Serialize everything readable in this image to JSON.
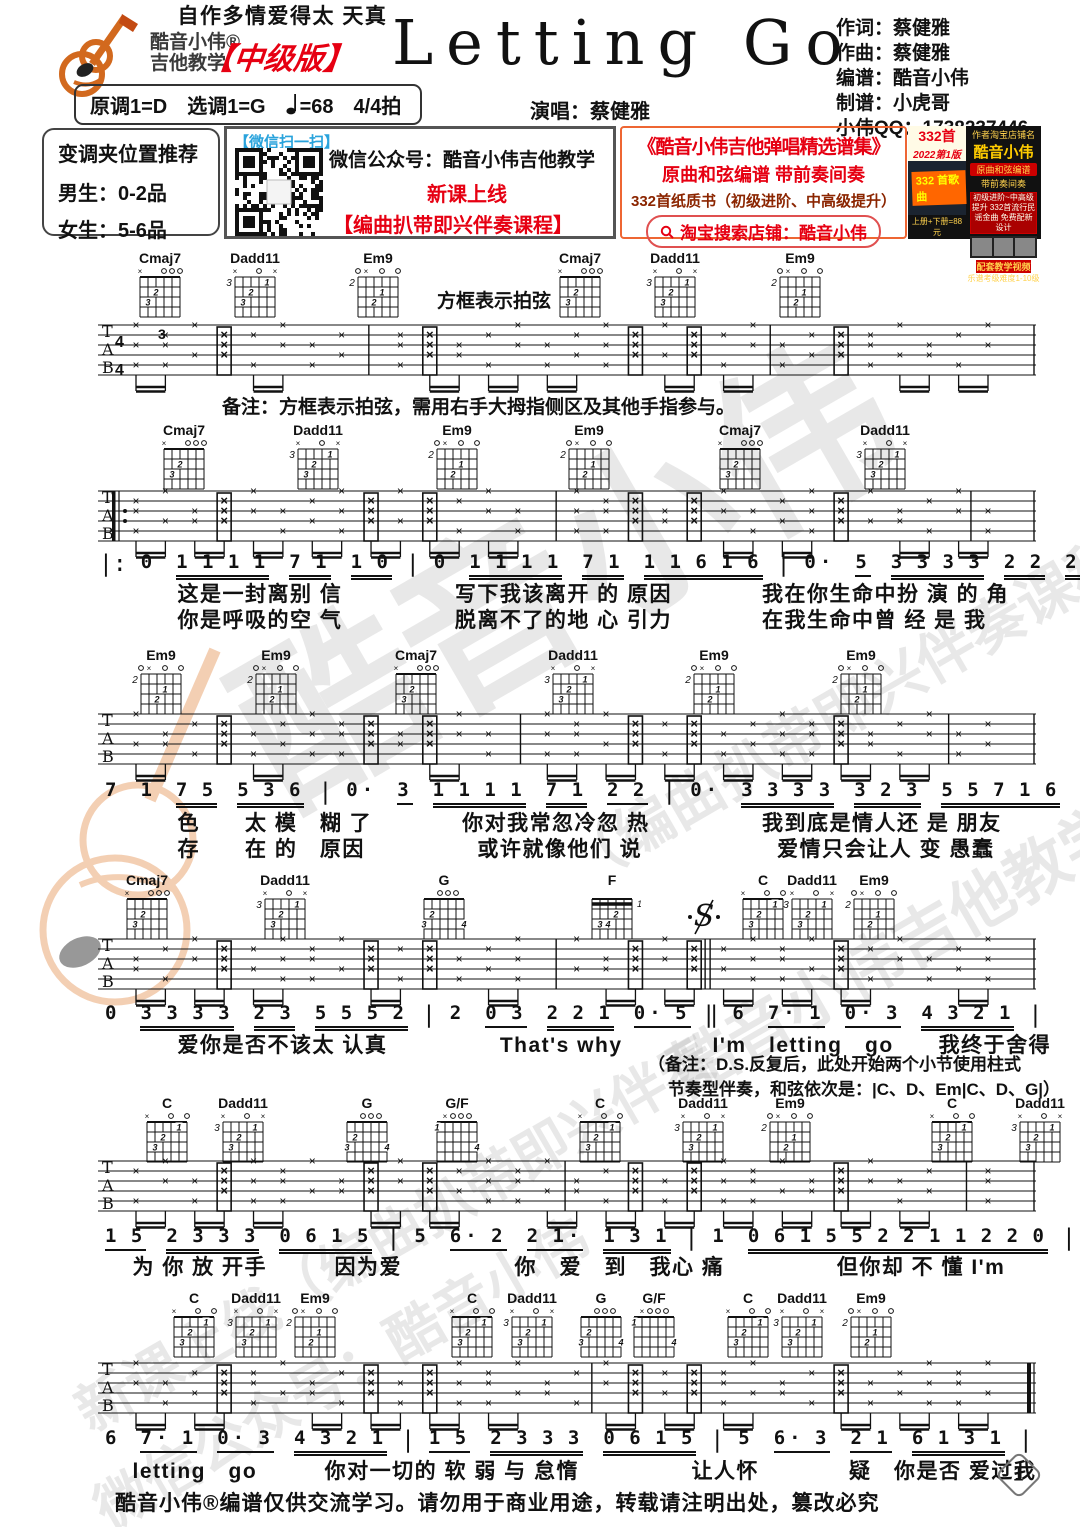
{
  "colors": {
    "red": "#e60012",
    "orange": "#e07b2a",
    "blue": "#29a3dc",
    "ink": "#111111"
  },
  "header": {
    "logo_line1": "酷音小伟®",
    "logo_line2": "吉他教学",
    "edition": "【中级版】",
    "title": "Letting Go",
    "credits": "作词：蔡健雅\n作曲：蔡健雅\n编谱：酷音小伟\n制谱：小虎哥\n小伟QQ：1738237446",
    "key_line": "原调1=D　选调1=G　",
    "tempo": "=68　4/4拍",
    "singer": "演唱：蔡健雅"
  },
  "info": {
    "capo_title": "变调夹位置推荐",
    "capo_male": "男生：0-2品",
    "capo_female": "女生：5-6品",
    "wechat_scan": "【微信扫一扫】",
    "wechat_account": "微信公众号：酷音小伟吉他教学",
    "wechat_new": "新课上线",
    "wechat_course": "【编曲扒带即兴伴奏课程】",
    "promo_title": "《酷音小伟吉他弹唱精选谱集》",
    "promo_line2": "原曲和弦编谱 带前奏间奏",
    "promo_line3": "332首纸质书（初级进阶、中高级提升）",
    "promo_search": "淘宝搜索店铺：酷音小伟",
    "badge_count": "332首",
    "badge_edition": "2022第1版",
    "badge_corner": "332 首歌曲",
    "price": "上册+下册=88元",
    "shop_caption": "作者淘宝店铺名",
    "shop_name": "酷音小伟",
    "shop_chip": "原曲和弦编谱",
    "shop_chip2": "带前奏间奏",
    "shop_box": "初级进阶~中高级提升 332首流行民谣金曲 免费配新设计",
    "video": "配套教学视频",
    "grade": "乐谱考级难度1-10级"
  },
  "notes": {
    "slap_label": "方框表示拍弦",
    "remark": "备注：方框表示拍弦，需用右手大拇指侧区及其他手指参与。",
    "ds_note_1": "（备注：D.S.反复后，此处开始两个小节使用柱式",
    "ds_note_2": "节奏型伴奏，和弦依次是：|C、D、Em|C、D、G|）"
  },
  "footer": {
    "text": "酷音小伟®编谱仅供交流学习。请勿用于商业用途，转载请注明出处，篡改必究",
    "page": "1"
  },
  "watermarks": [
    {
      "text": "酷音小伟",
      "x": 200,
      "y": 430,
      "size": 180,
      "rot": -30
    },
    {
      "text": "（编曲扒带即兴伴奏课程）",
      "x": 520,
      "y": 650,
      "size": 58,
      "rot": -30
    },
    {
      "text": "酷音小伟吉他教学",
      "x": 640,
      "y": 900,
      "size": 64,
      "rot": -30
    },
    {
      "text": "新课上线（编曲扒带即兴伴奏",
      "x": 30,
      "y": 1190,
      "size": 56,
      "rot": -30
    },
    {
      "text": "微信公众号：酷音小伟",
      "x": 60,
      "y": 1330,
      "size": 56,
      "rot": -30
    }
  ],
  "chord_shapes": {
    "Cmaj7": {
      "pos": "",
      "marks": [
        "x",
        "",
        "",
        "o",
        "o",
        "o"
      ],
      "dots": [
        {
          "s": 1,
          "f": 3,
          "n": "3"
        },
        {
          "s": 2,
          "f": 2,
          "n": "2"
        }
      ]
    },
    "Dadd11": {
      "pos": "3",
      "marks": [
        "x",
        "",
        "",
        "o",
        "",
        "x"
      ],
      "dots": [
        {
          "s": 1,
          "f": 3,
          "n": "3"
        },
        {
          "s": 2,
          "f": 2,
          "n": "2"
        },
        {
          "s": 4,
          "f": 1,
          "n": "1"
        }
      ]
    },
    "Em9": {
      "pos": "2",
      "marks": [
        "o",
        "x",
        "",
        "o",
        "",
        "o"
      ],
      "dots": [
        {
          "s": 2,
          "f": 3,
          "n": "2"
        },
        {
          "s": 3,
          "f": 2,
          "n": "1"
        }
      ]
    },
    "G": {
      "pos": "",
      "marks": [
        "",
        "",
        "o",
        "o",
        "o",
        ""
      ],
      "dots": [
        {
          "s": 1,
          "f": 2,
          "n": "2"
        },
        {
          "s": 0,
          "f": 3,
          "n": "3"
        },
        {
          "s": 5,
          "f": 3,
          "n": "4"
        }
      ]
    },
    "F": {
      "pos": "",
      "marks": [
        "",
        "",
        "",
        "",
        "",
        ""
      ],
      "barre": true,
      "arrow": "1",
      "dots": [
        {
          "s": 1,
          "f": 3,
          "n": "3"
        },
        {
          "s": 2,
          "f": 3,
          "n": "4"
        },
        {
          "s": 3,
          "f": 2,
          "n": "2"
        }
      ]
    },
    "C": {
      "pos": "",
      "marks": [
        "x",
        "",
        "",
        "o",
        "",
        "o"
      ],
      "dots": [
        {
          "s": 1,
          "f": 3,
          "n": "3"
        },
        {
          "s": 2,
          "f": 2,
          "n": "2"
        },
        {
          "s": 4,
          "f": 1,
          "n": "1"
        }
      ]
    },
    "G/F": {
      "pos": "",
      "marks": [
        "",
        "x",
        "o",
        "o",
        "o",
        ""
      ],
      "dots": [
        {
          "s": 0,
          "f": 1,
          "n": "1"
        },
        {
          "s": 5,
          "f": 3,
          "n": "4"
        }
      ]
    }
  },
  "music": {
    "staff_letters": [
      "T",
      "A",
      "B"
    ],
    "time_signature": [
      "4",
      "4"
    ],
    "systems": [
      {
        "chordsY": 250,
        "staffY": 311,
        "time": true,
        "triplet": "3",
        "bars": [
          0.27,
          0.72
        ],
        "slap_label_x": 437,
        "slap_label_y": 286,
        "chords": [
          {
            "name": "Cmaj7",
            "x": 160
          },
          {
            "name": "Dadd11",
            "x": 255
          },
          {
            "name": "Em9",
            "x": 378
          },
          {
            "name": "Cmaj7",
            "x": 580
          },
          {
            "name": "Dadd11",
            "x": 675
          },
          {
            "name": "Em9",
            "x": 800
          }
        ]
      },
      {
        "chordsY": 422,
        "staffY": 477,
        "repeat_start": true,
        "bars": [
          0.48,
          0.945
        ],
        "melodyY": 551,
        "lyricY": [
          578,
          604
        ],
        "chords": [
          {
            "name": "Cmaj7",
            "x": 184
          },
          {
            "name": "Dadd11",
            "x": 318
          },
          {
            "name": "Em9",
            "x": 457
          },
          {
            "name": "Em9",
            "x": 589
          },
          {
            "name": "Cmaj7",
            "x": 740
          },
          {
            "name": "Dadd11",
            "x": 885
          }
        ],
        "melody": [
          {
            "bar": "|:"
          },
          {
            "t": "0"
          },
          {
            "t": "1 1 1 1",
            "u": 2
          },
          {
            "t": "7 1",
            "u": 2
          },
          {
            "t": "1 0",
            "u": 2
          },
          {
            "bar": "|"
          },
          {
            "t": "0"
          },
          {
            "t": "1 1 1 1",
            "u": 2
          },
          {
            "t": "7 1",
            "u": 2
          },
          {
            "t": "1 1 6 1 6",
            "u": 2
          },
          {
            "bar": "|"
          },
          {
            "t": "0·"
          },
          {
            "t": "5",
            "u": 1
          },
          {
            "t": "3 3 3 3",
            "u": 2
          },
          {
            "t": "2 2",
            "u": 2
          },
          {
            "t": "2 0 1 7",
            "u": 2
          },
          {
            "bar": "|"
          }
        ],
        "lyrics": [
          "　　　这是一封离别 信　　　　　写下我该离开 的 原因　　　　我在你生命中扮 演 的 角",
          "　　　你是呼吸的空 气　　　　　脱离不了的地 心 引力　　　　在我生命中曾 经 是 我"
        ]
      },
      {
        "chordsY": 647,
        "staffY": 700,
        "bars": [
          0.44,
          0.92
        ],
        "melodyY": 779,
        "lyricY": [
          807,
          833
        ],
        "chords": [
          {
            "name": "Em9",
            "x": 161
          },
          {
            "name": "Em9",
            "x": 276
          },
          {
            "name": "Cmaj7",
            "x": 416
          },
          {
            "name": "Dadd11",
            "x": 573
          },
          {
            "name": "Em9",
            "x": 714
          },
          {
            "name": "Em9",
            "x": 861
          }
        ],
        "melody": [
          {
            "t": "7"
          },
          {
            "t": "1"
          },
          {
            "t": "7 5",
            "u": 2
          },
          {
            "t": "5 3 6",
            "u": 2
          },
          {
            "bar": "|"
          },
          {
            "t": "0·"
          },
          {
            "t": "3",
            "u": 1
          },
          {
            "t": "1 1 1 1",
            "u": 2
          },
          {
            "t": "7 1",
            "u": 2
          },
          {
            "t": "2 2",
            "u": 1
          },
          {
            "bar": "|"
          },
          {
            "t": "0·"
          },
          {
            "t": "3 3 3 3",
            "u": 2
          },
          {
            "t": "3 2 3",
            "u": 2
          },
          {
            "t": "5 5 7 1 6",
            "u": 2
          },
          {
            "bar": "|"
          }
        ],
        "lyrics": [
          "　　　色　　太 模　糊 了　　　　你对我常忽冷忽 热　　　　　我到底是情人还 是 朋友",
          "　　　存　　在 的　原因　　　　　或许就像他们 说　　　　　　爱情只会让人 变 愚蠢"
        ]
      },
      {
        "chordsY": 872,
        "staffY": 925,
        "bars": [
          0.48
        ],
        "double_bar": 0.647,
        "segno": {
          "x": 686,
          "y": 896
        },
        "melodyY": 1002,
        "lyricY": [
          1029
        ],
        "chords": [
          {
            "name": "Cmaj7",
            "x": 147
          },
          {
            "name": "Dadd11",
            "x": 285
          },
          {
            "name": "G",
            "x": 444
          },
          {
            "name": "F",
            "x": 612
          },
          {
            "name": "C",
            "x": 763
          },
          {
            "name": "Dadd11",
            "x": 812
          },
          {
            "name": "Em9",
            "x": 874
          }
        ],
        "melody": [
          {
            "t": "0"
          },
          {
            "t": "3 3 3 3",
            "u": 2
          },
          {
            "t": "2 3",
            "u": 2
          },
          {
            "t": "5 5 5 2",
            "u": 2
          },
          {
            "bar": "|"
          },
          {
            "t": "2"
          },
          {
            "t": "0 3",
            "u": 1
          },
          {
            "t": "2 2 1",
            "u": 2
          },
          {
            "t": "0· 5",
            "u": 1
          },
          {
            "bar": "‖"
          },
          {
            "t": "6"
          },
          {
            "t": "7· 1",
            "u": 1
          },
          {
            "t": "0· 3",
            "u": 1
          },
          {
            "t": "4 3 2 1",
            "u": 2
          },
          {
            "bar": "|"
          }
        ],
        "lyrics": [
          "　　　爱你是否不该太 认真　　　　　That's why　　　　I'm　letting　go　　我终于舍得",
          "　　　自作多情爱得太 天真"
        ]
      },
      {
        "chordsY": 1095,
        "staffY": 1147,
        "bars": [
          0.49,
          0.94
        ],
        "melodyY": 1225,
        "lyricY": [
          1251
        ],
        "chords": [
          {
            "name": "C",
            "x": 167
          },
          {
            "name": "Dadd11",
            "x": 243
          },
          {
            "name": "G",
            "x": 367
          },
          {
            "name": "G/F",
            "x": 457
          },
          {
            "name": "C",
            "x": 600
          },
          {
            "name": "Dadd11",
            "x": 703
          },
          {
            "name": "Em9",
            "x": 790
          },
          {
            "name": "C",
            "x": 952
          },
          {
            "name": "Dadd11",
            "x": 1040
          }
        ],
        "melody": [
          {
            "t": "1 5",
            "u": 1
          },
          {
            "t": "2 3 3 3",
            "u": 2
          },
          {
            "t": "0 6 1 5",
            "u": 2
          },
          {
            "bar": "|"
          },
          {
            "t": "5"
          },
          {
            "t": "6· 2",
            "u": 1
          },
          {
            "t": "2 1·",
            "u": 1
          },
          {
            "t": "1 3 1",
            "u": 2
          },
          {
            "bar": "|"
          },
          {
            "t": "1"
          },
          {
            "t": "0 6 1 5 5 2 2 1 1 2 2 0",
            "u": 2
          },
          {
            "bar": "|"
          }
        ],
        "lyrics": [
          "　为 你 放 开手　　　因为爱　　　　　你　爱　到　我心 痛　　　　　但你却 不 懂 I'm"
        ]
      },
      {
        "chordsY": 1290,
        "staffY": 1349,
        "bars": [
          0.52
        ],
        "final": true,
        "melodyY": 1427,
        "lyricY": [
          1455
        ],
        "chords": [
          {
            "name": "C",
            "x": 194
          },
          {
            "name": "Dadd11",
            "x": 256
          },
          {
            "name": "Em9",
            "x": 315
          },
          {
            "name": "C",
            "x": 472
          },
          {
            "name": "Dadd11",
            "x": 532
          },
          {
            "name": "G",
            "x": 601
          },
          {
            "name": "G/F",
            "x": 654
          },
          {
            "name": "C",
            "x": 748
          },
          {
            "name": "Dadd11",
            "x": 802
          },
          {
            "name": "Em9",
            "x": 871
          }
        ],
        "melody": [
          {
            "t": "6"
          },
          {
            "t": "7· 1",
            "u": 1
          },
          {
            "t": "0· 3",
            "u": 1
          },
          {
            "t": "4 3 2 1",
            "u": 2
          },
          {
            "bar": "|"
          },
          {
            "t": "1 5",
            "u": 1
          },
          {
            "t": "2 3 3 3",
            "u": 2
          },
          {
            "t": "0 6 1 5",
            "u": 2
          },
          {
            "bar": "|"
          },
          {
            "t": "5"
          },
          {
            "t": "6· 3",
            "u": 1
          },
          {
            "t": "2 1",
            "u": 1
          },
          {
            "t": "6 1 3 1",
            "u": 2
          },
          {
            "bar": "|"
          }
        ],
        "lyrics": [
          "　letting　go　　　你对一切的 软 弱 与 怠惰　　　　　让人怀　　　　疑　你是否 爱过我"
        ]
      }
    ]
  }
}
